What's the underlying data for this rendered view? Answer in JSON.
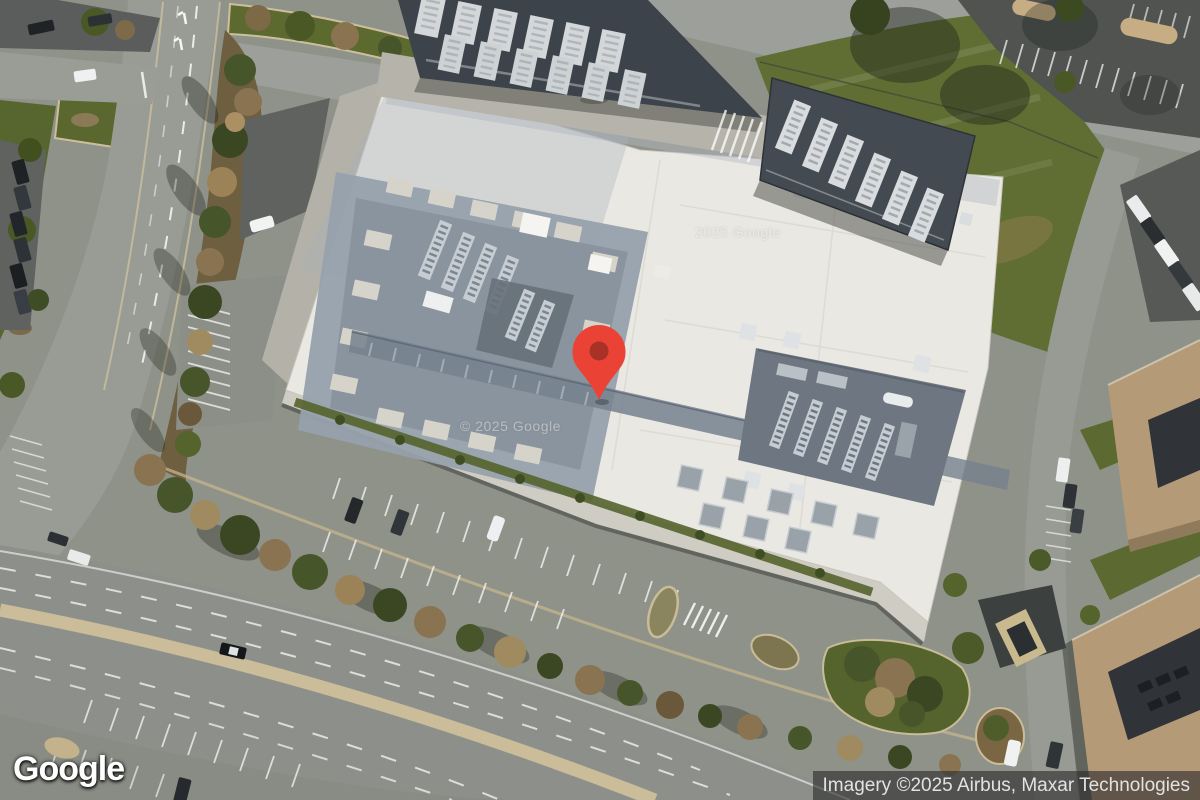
{
  "map": {
    "view_type": "satellite",
    "marker": {
      "label": "map-marker",
      "color": "#EA4335",
      "inner_color": "#A93226"
    },
    "watermarks": {
      "upper": "2025 Google",
      "lower": "© 2025 Google"
    }
  },
  "footer": {
    "logo_text": "Google",
    "attribution_text": "Imagery ©2025 Airbus, Maxar Technologies"
  }
}
